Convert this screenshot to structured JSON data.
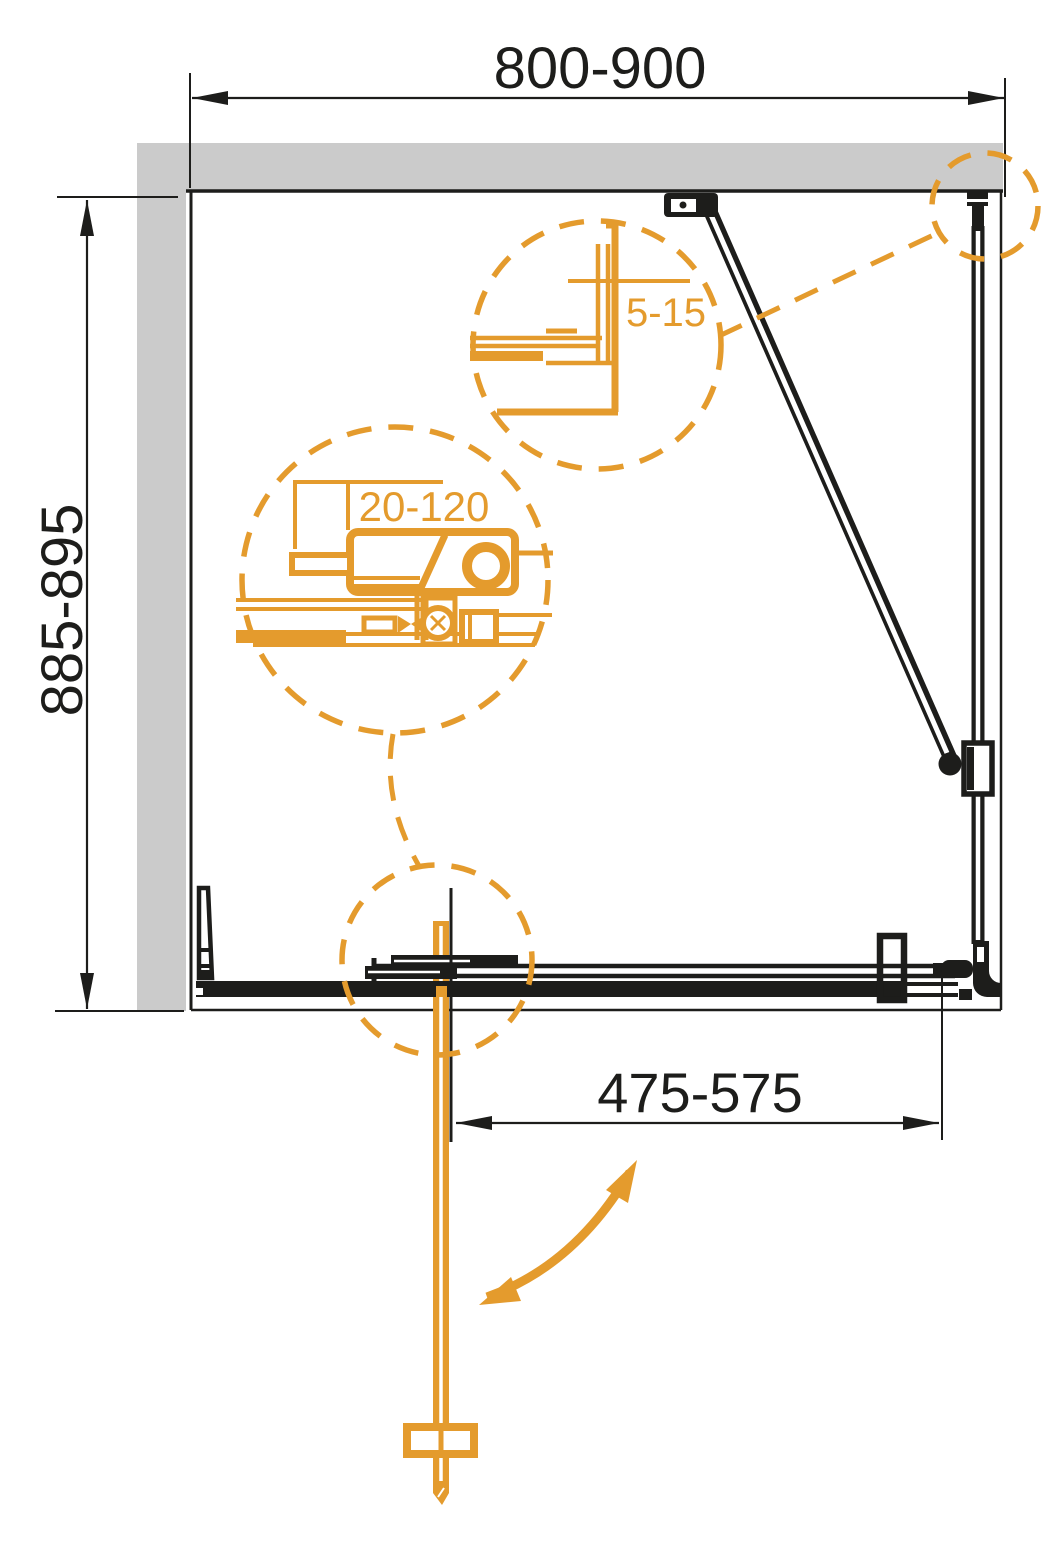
{
  "drawing": {
    "kind": "shower-enclosure-technical-top-view",
    "colors": {
      "line_black": "#1D1D1B",
      "accent_orange": "#E49B2D",
      "wall_gray": "#CBCBCB",
      "background": "#FFFFFF"
    },
    "dimensions": {
      "overall_width": "800-900",
      "overall_depth": "885-895",
      "door_opening_width": "475-575"
    },
    "details": {
      "corner_gap_range": "5-15",
      "wall_profile_adjustment_range": "20-120"
    }
  }
}
